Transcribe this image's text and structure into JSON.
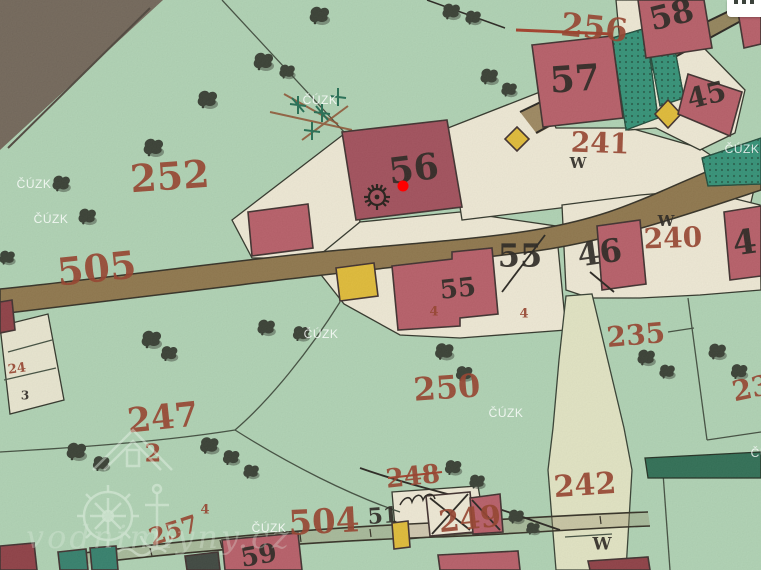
{
  "map": {
    "colors": {
      "parcel_red": "#943d27",
      "house_black": "#241f1a",
      "marker_red": "#ff0000",
      "watermark_white": "#ffffff"
    },
    "marker": {
      "x": 403,
      "y": 186
    },
    "cuzk_text": "ČÚZK",
    "brand": {
      "text": "vodnimlyny.cz"
    },
    "menu_button": {
      "icon": "ellipsis-icon"
    },
    "labels": [
      {
        "text": "252",
        "x": 170,
        "y": 180,
        "size": 38,
        "rot": -4,
        "color": "red"
      },
      {
        "text": "505",
        "x": 97,
        "y": 272,
        "size": 38,
        "rot": -6,
        "color": "red"
      },
      {
        "text": "256",
        "x": 594,
        "y": 30,
        "size": 32,
        "rot": 6,
        "color": "red"
      },
      {
        "text": "241",
        "x": 600,
        "y": 145,
        "size": 28,
        "rot": 2,
        "color": "red"
      },
      {
        "text": "240",
        "x": 673,
        "y": 240,
        "size": 28,
        "rot": -2,
        "color": "red"
      },
      {
        "text": "235",
        "x": 636,
        "y": 337,
        "size": 28,
        "rot": -5,
        "color": "red"
      },
      {
        "text": "250",
        "x": 447,
        "y": 390,
        "size": 32,
        "rot": -4,
        "color": "red"
      },
      {
        "text": "247",
        "x": 163,
        "y": 420,
        "size": 34,
        "rot": -6,
        "color": "red"
      },
      {
        "text": "2",
        "x": 153,
        "y": 455,
        "size": 24,
        "rot": 0,
        "color": "red"
      },
      {
        "text": "242",
        "x": 585,
        "y": 487,
        "size": 30,
        "rot": -4,
        "color": "red"
      },
      {
        "text": "248",
        "x": 413,
        "y": 478,
        "size": 26,
        "rot": -6,
        "color": "red"
      },
      {
        "text": "249",
        "x": 470,
        "y": 521,
        "size": 30,
        "rot": -6,
        "color": "red"
      },
      {
        "text": "504",
        "x": 324,
        "y": 524,
        "size": 34,
        "rot": -3,
        "color": "red"
      },
      {
        "text": "257",
        "x": 174,
        "y": 532,
        "size": 24,
        "rot": -18,
        "color": "red"
      },
      {
        "text": "23",
        "x": 752,
        "y": 390,
        "size": 28,
        "rot": -12,
        "color": "red"
      },
      {
        "text": "24",
        "x": 17,
        "y": 369,
        "size": 13,
        "rot": -8,
        "color": "red"
      },
      {
        "text": "4",
        "x": 434,
        "y": 312,
        "size": 13,
        "rot": 0,
        "color": "red"
      },
      {
        "text": "4",
        "x": 524,
        "y": 314,
        "size": 13,
        "rot": 0,
        "color": "red"
      },
      {
        "text": "4",
        "x": 205,
        "y": 510,
        "size": 13,
        "rot": 0,
        "color": "red"
      },
      {
        "text": "56",
        "x": 414,
        "y": 172,
        "size": 36,
        "rot": -7,
        "color": "black"
      },
      {
        "text": "57",
        "x": 575,
        "y": 82,
        "size": 36,
        "rot": -4,
        "color": "black"
      },
      {
        "text": "58",
        "x": 672,
        "y": 17,
        "size": 32,
        "rot": -14,
        "color": "black"
      },
      {
        "text": "45",
        "x": 707,
        "y": 97,
        "size": 28,
        "rot": -14,
        "color": "black"
      },
      {
        "text": "55",
        "x": 520,
        "y": 258,
        "size": 32,
        "rot": 0,
        "color": "black"
      },
      {
        "text": "55",
        "x": 458,
        "y": 290,
        "size": 26,
        "rot": -6,
        "color": "black"
      },
      {
        "text": "46",
        "x": 600,
        "y": 255,
        "size": 32,
        "rot": -8,
        "color": "black"
      },
      {
        "text": "4",
        "x": 745,
        "y": 245,
        "size": 34,
        "rot": -8,
        "color": "black"
      },
      {
        "text": "59",
        "x": 259,
        "y": 557,
        "size": 26,
        "rot": -10,
        "color": "black"
      },
      {
        "text": "51",
        "x": 383,
        "y": 517,
        "size": 22,
        "rot": -4,
        "color": "black"
      },
      {
        "text": "3",
        "x": 25,
        "y": 396,
        "size": 12,
        "rot": 0,
        "color": "black"
      },
      {
        "text": "W",
        "x": 578,
        "y": 164,
        "size": 15,
        "rot": 0,
        "color": "black"
      },
      {
        "text": "W",
        "x": 666,
        "y": 222,
        "size": 15,
        "rot": 0,
        "color": "black"
      },
      {
        "text": "W",
        "x": 602,
        "y": 545,
        "size": 17,
        "rot": 0,
        "color": "black"
      }
    ],
    "cuzk_watermarks": [
      {
        "x": 34,
        "y": 188
      },
      {
        "x": 51,
        "y": 223
      },
      {
        "x": 320,
        "y": 104
      },
      {
        "x": 742,
        "y": 153
      },
      {
        "x": 321,
        "y": 338
      },
      {
        "x": 506,
        "y": 417
      },
      {
        "x": 269,
        "y": 532
      },
      {
        "x": 768,
        "y": 457
      }
    ],
    "trees": [
      {
        "x": 318,
        "y": 16,
        "s": 1
      },
      {
        "x": 262,
        "y": 62,
        "s": 1
      },
      {
        "x": 286,
        "y": 72,
        "s": 0.8
      },
      {
        "x": 206,
        "y": 100,
        "s": 1
      },
      {
        "x": 152,
        "y": 148,
        "s": 1
      },
      {
        "x": 60,
        "y": 184,
        "s": 0.9
      },
      {
        "x": 86,
        "y": 217,
        "s": 0.9
      },
      {
        "x": 6,
        "y": 258,
        "s": 0.8
      },
      {
        "x": 450,
        "y": 12,
        "s": 0.9
      },
      {
        "x": 472,
        "y": 18,
        "s": 0.8
      },
      {
        "x": 488,
        "y": 77,
        "s": 0.9
      },
      {
        "x": 508,
        "y": 90,
        "s": 0.8
      },
      {
        "x": 150,
        "y": 340,
        "s": 1
      },
      {
        "x": 168,
        "y": 354,
        "s": 0.85
      },
      {
        "x": 265,
        "y": 328,
        "s": 0.9
      },
      {
        "x": 300,
        "y": 334,
        "s": 0.85
      },
      {
        "x": 443,
        "y": 352,
        "s": 0.95
      },
      {
        "x": 463,
        "y": 374,
        "s": 0.85
      },
      {
        "x": 645,
        "y": 358,
        "s": 0.9
      },
      {
        "x": 666,
        "y": 372,
        "s": 0.8
      },
      {
        "x": 716,
        "y": 352,
        "s": 0.9
      },
      {
        "x": 738,
        "y": 372,
        "s": 0.85
      },
      {
        "x": 75,
        "y": 452,
        "s": 1
      },
      {
        "x": 100,
        "y": 464,
        "s": 0.85
      },
      {
        "x": 208,
        "y": 446,
        "s": 0.95
      },
      {
        "x": 230,
        "y": 458,
        "s": 0.85
      },
      {
        "x": 250,
        "y": 472,
        "s": 0.8
      },
      {
        "x": 452,
        "y": 468,
        "s": 0.85
      },
      {
        "x": 476,
        "y": 482,
        "s": 0.8
      },
      {
        "x": 515,
        "y": 517,
        "s": 0.8
      },
      {
        "x": 532,
        "y": 529,
        "s": 0.7
      }
    ]
  }
}
